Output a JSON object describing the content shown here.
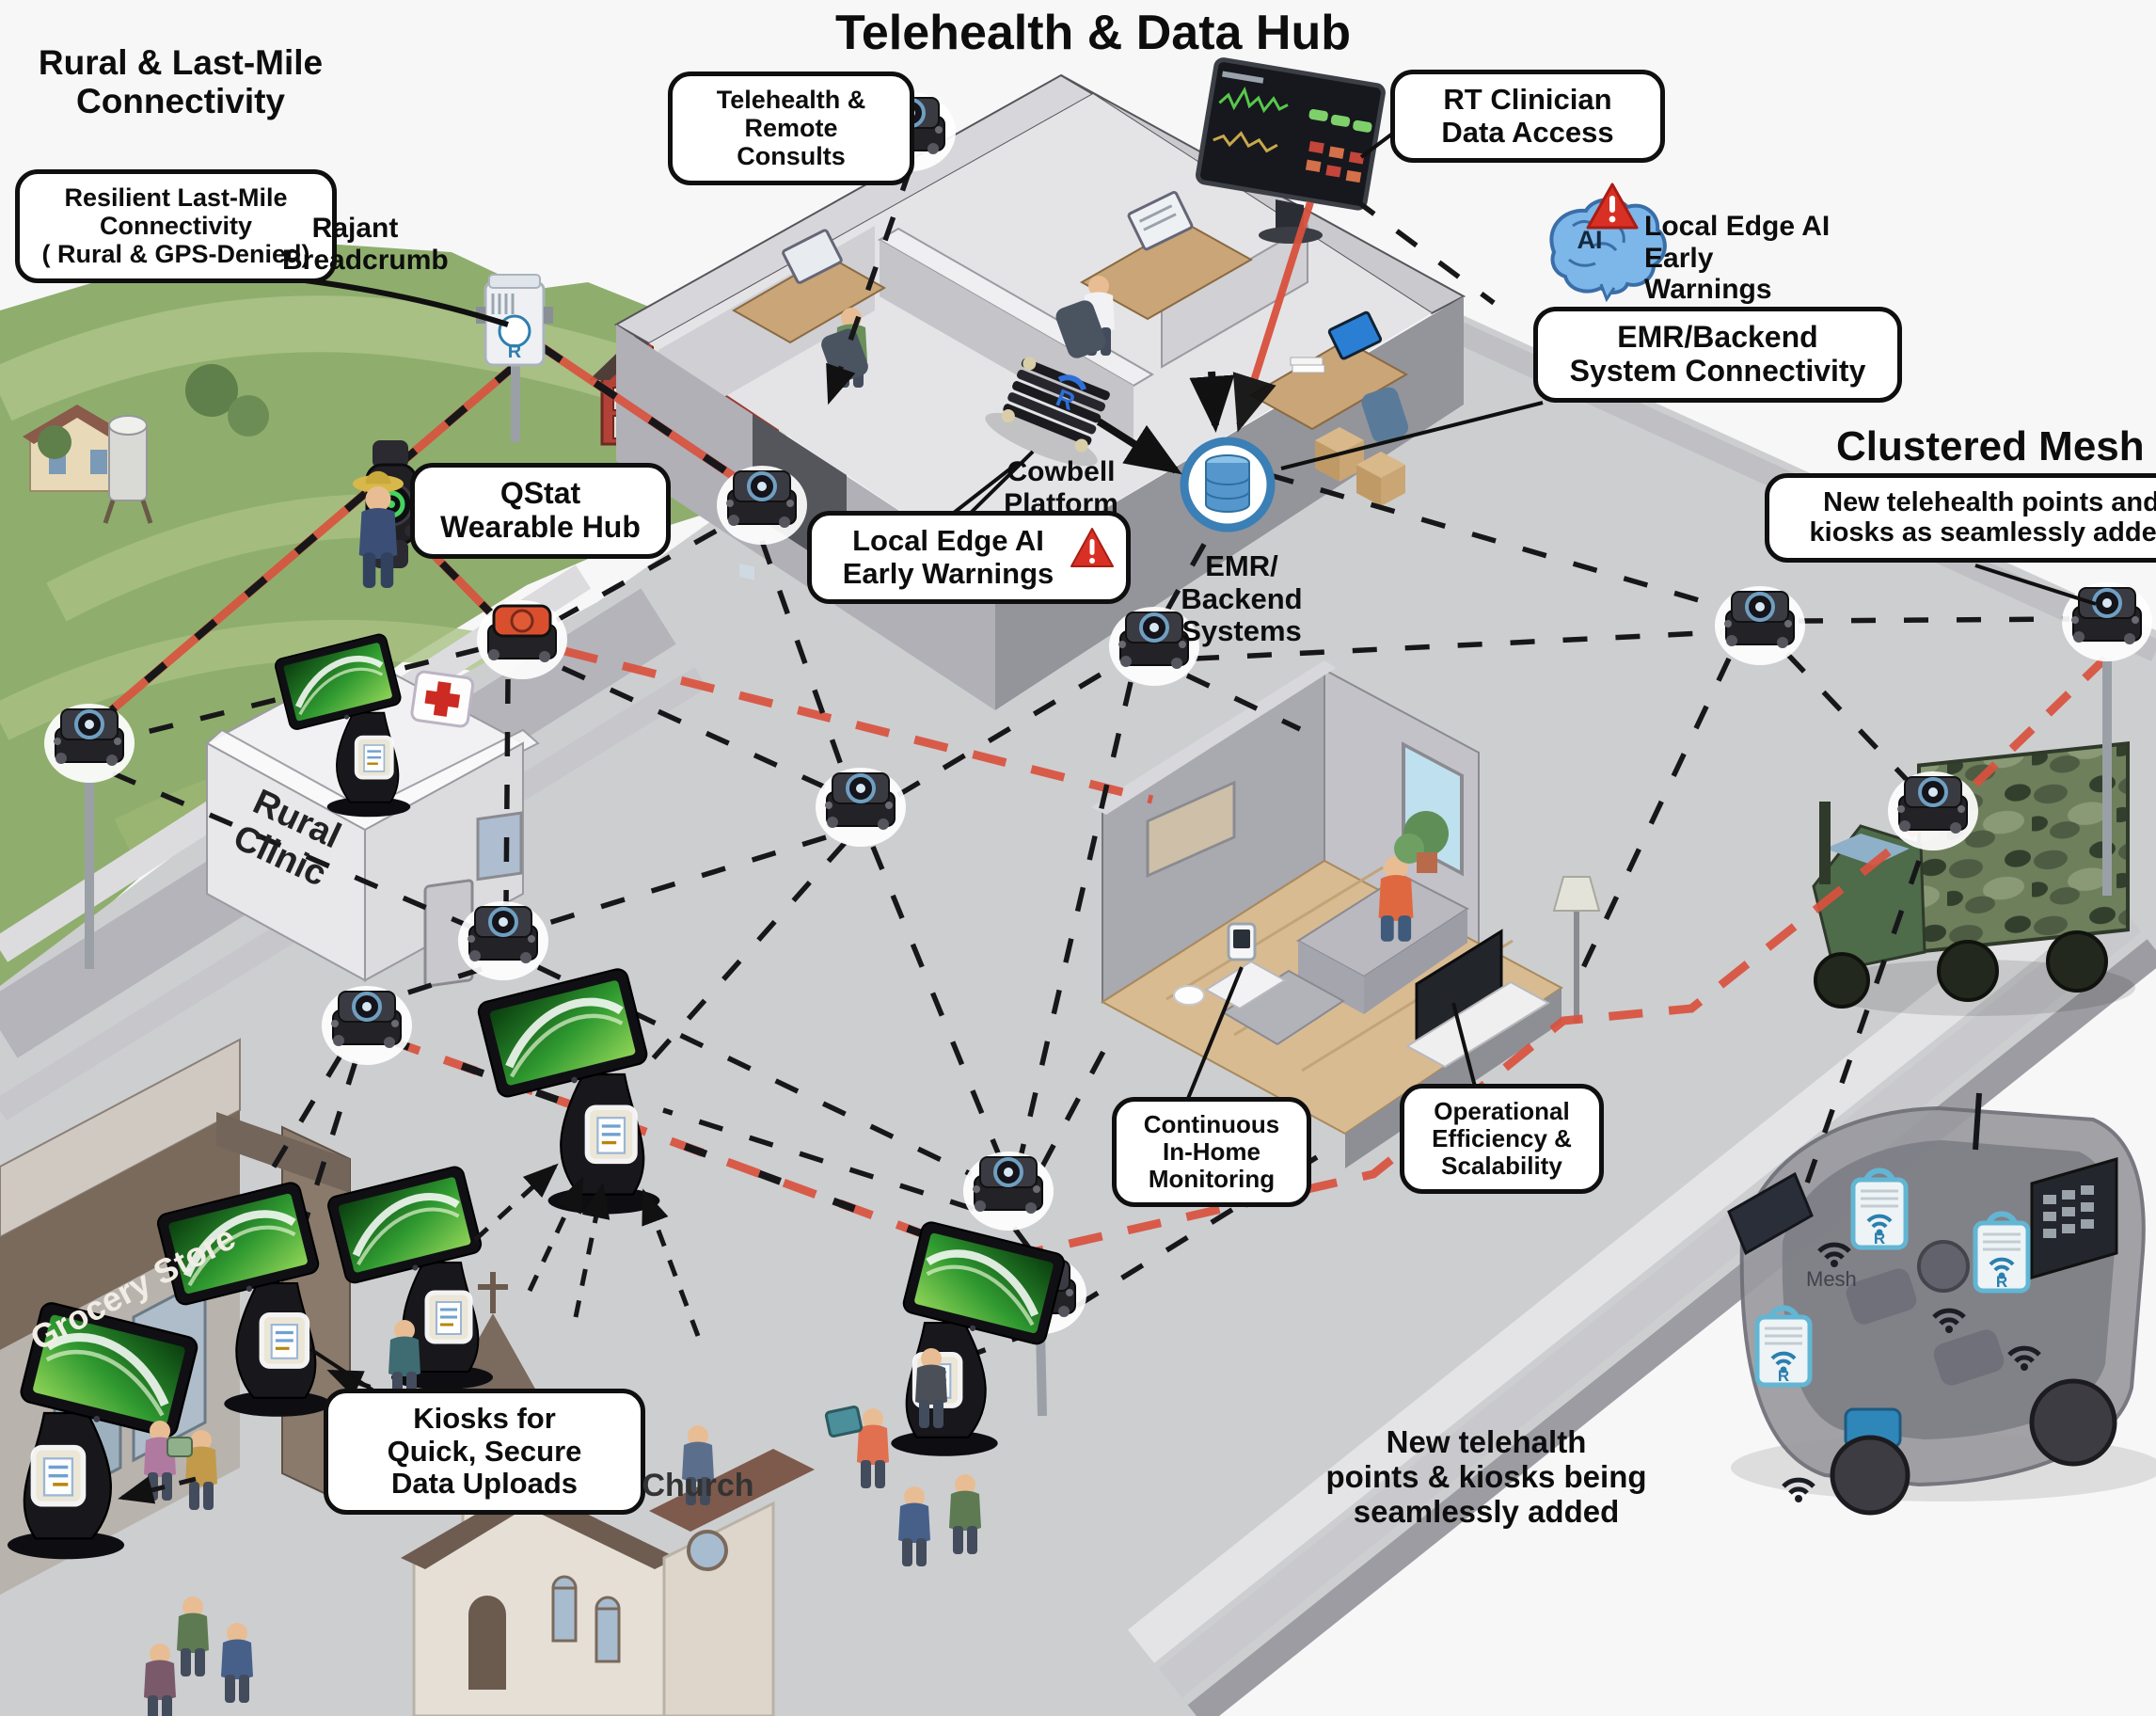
{
  "title": "Telehealth & Data Hub",
  "headings": {
    "rural_last_mile": "Rural & Last-Mile\nConnectivity",
    "clustered_mesh": "Clustered Mesh"
  },
  "callouts": {
    "resilient": "Resilient Last-Mile\nConnectivity\n( Rural & GPS-Denied)",
    "rajant_breadcrumb": "Rajant\nBreadcrumb",
    "qstat": "QStat\nWearable Hub",
    "telehealth_consults": "Telehealth &\nRemote Consults",
    "rt_clinician": "RT Clinician\nData Access",
    "edge_ai_right": "Local Edge AI\nEarly Warnings",
    "emr_connectivity": "EMR/Backend\nSystem Connectivity",
    "new_points_right": "New telehealth points and\nkiosks as seamlessly added",
    "cowbell": "Cowbell\nPlatform",
    "edge_ai_center": "Local Edge AI\nEarly Warnings",
    "emr_systems": "EMR/\nBackend\nSystems",
    "continuous": "Continuous\nIn-Home\nMonitoring",
    "operational": "Operational\nEfficiency &\nScalability",
    "kiosks_uploads": "Kiosks for\nQuick, Secure\nData Uploads",
    "new_points_bottom": "New telehalth\npoints & kiosks being\nseamlessly added"
  },
  "scene": {
    "buildings": {
      "rural_clinic": "Rural\nClinic",
      "grocery_store": "Grocery Store",
      "church": "Church"
    },
    "van_label": "Mesh",
    "ai_badge": "AI"
  },
  "icons": {
    "ai_brain": "ai-brain-icon",
    "warning": "warning-triangle-icon",
    "database": "database-icon",
    "medical_cross": "medical-cross-icon",
    "wifi": "wifi-icon",
    "mesh_node": "mesh-node-device"
  },
  "colors": {
    "callout_border": "#0f0f0f",
    "mesh_link_black": "#17171a",
    "resilient_link_red": "#d9513d",
    "warning_red": "#d93025",
    "ai_blue": "#7db6e8",
    "emr_blue": "#3a7fb5",
    "kiosk_screen_green": "#3fae3a",
    "hills_green": "#8fae6d",
    "plaza_gray": "#cdced0",
    "truck_green": "#5d6f52"
  }
}
